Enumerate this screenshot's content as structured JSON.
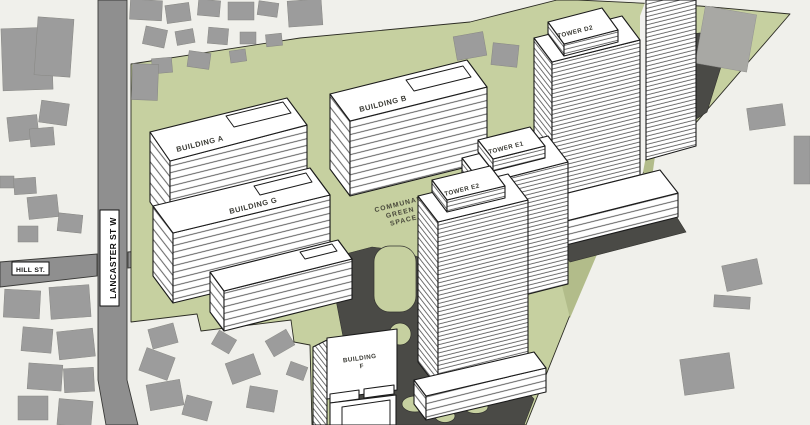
{
  "colors": {
    "background": "#f0f0eb",
    "site_green": "#c6d0a0",
    "shade_green": "#b2bc8a",
    "road": "#8f8f8f",
    "driveway": "#4a4a46",
    "house": "#9c9c9c",
    "outline": "#1b1b1b"
  },
  "streets": {
    "lancaster": "LANCASTER ST W",
    "hill": "HILL ST."
  },
  "open_space": {
    "line1": "COMMUNAL",
    "line2": "GREEN",
    "line3": "SPACE"
  },
  "buildings": {
    "a": {
      "label": "BUILDING A"
    },
    "b": {
      "label": "BUILDING B"
    },
    "g": {
      "label": "BUILDING G"
    },
    "f": {
      "label_line1": "BUILDING",
      "label_line2": "F"
    },
    "tower_d2": {
      "label": "TOWER D2"
    },
    "tower_e1": {
      "label": "TOWER E1"
    },
    "tower_e2": {
      "label": "TOWER E2"
    }
  }
}
